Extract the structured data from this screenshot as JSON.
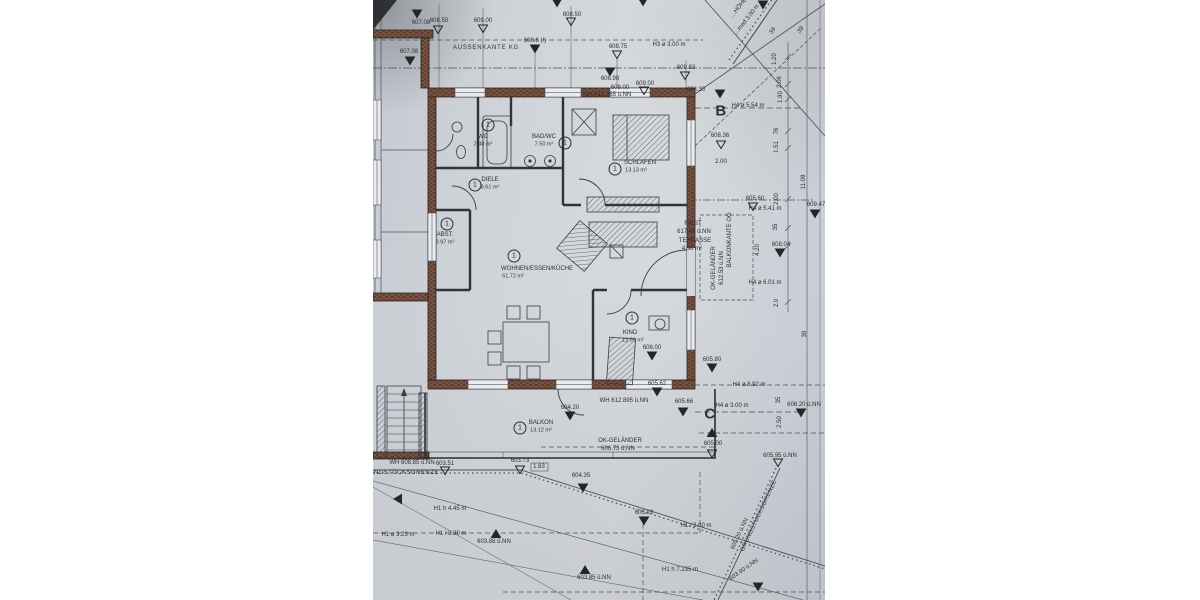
{
  "colors": {
    "paper": "#d0d4da",
    "linework": "#4c5058",
    "wall_brick": "#7a5140",
    "wall_brick_dark": "#503a2f",
    "text": "#2c2f34",
    "margin": "#ffffff"
  },
  "rooms": [
    {
      "number": "1",
      "label": "WC",
      "area": "2.40 m²",
      "x": 110,
      "y": 137,
      "badge_x": 115,
      "badge_y": 125
    },
    {
      "number": "1",
      "label": "BAD/WC",
      "area": "7.50 m²",
      "x": 171,
      "y": 137,
      "badge_x": 192,
      "badge_y": 143
    },
    {
      "number": "1",
      "label": "SCHLAFEN",
      "area": "13.13 m²",
      "x": 267,
      "y": 163,
      "ax": 263,
      "badge_x": 242,
      "badge_y": 169
    },
    {
      "number": "1",
      "label": "DIELE",
      "area": "8.61 m²",
      "x": 117,
      "y": 180,
      "badge_x": 102,
      "badge_y": 185
    },
    {
      "number": "1",
      "label": "ABST.",
      "area": "3.97 m²",
      "x": 72,
      "y": 235,
      "badge_x": 74,
      "badge_y": 224
    },
    {
      "number": "1",
      "label": "WOHNEN/ESSEN/KÜCHE",
      "area": "51.72 m²",
      "x": 164,
      "y": 269,
      "ax": 140,
      "badge_x": 141,
      "badge_y": 256
    },
    {
      "number": "1",
      "label": "KIND",
      "area": "12.99 m²",
      "x": 257,
      "y": 333,
      "ax": 260,
      "badge_x": 259,
      "badge_y": 318
    },
    {
      "number": "1",
      "label": "BALKON",
      "area": "13.12 m²",
      "x": 168,
      "y": 423,
      "badge_x": 147,
      "badge_y": 428
    }
  ],
  "section_markers": [
    {
      "letter": "B",
      "x": 348,
      "y": 111
    },
    {
      "letter": "C",
      "x": 337,
      "y": 414
    }
  ],
  "annotations": [
    {
      "t": "607.08",
      "x": 48,
      "y": 23
    },
    {
      "t": "608.50",
      "x": 66,
      "y": 21
    },
    {
      "t": "609.00",
      "x": 110,
      "y": 21
    },
    {
      "t": "608.50",
      "x": 199,
      "y": 15
    },
    {
      "t": "608.6 (!)",
      "x": 162,
      "y": 41
    },
    {
      "t": "AUSSENKANTE KG",
      "x": 113,
      "y": 48,
      "ls": 0.8
    },
    {
      "t": "608.75",
      "x": 245,
      "y": 47
    },
    {
      "t": "H3 ø 3.00 m",
      "x": 296,
      "y": 45
    },
    {
      "t": "607.08",
      "x": 36,
      "y": 52
    },
    {
      "t": "609.83",
      "x": 313,
      "y": 68
    },
    {
      "t": "606.98",
      "x": 237,
      "y": 79
    },
    {
      "t": "609.00",
      "x": 272,
      "y": 84
    },
    {
      "t": "608.00",
      "x": 247,
      "y": 88
    },
    {
      "t": "WH 612.365 ü.NN",
      "x": 234,
      "y": 95
    },
    {
      "t": "608.30",
      "x": 323,
      "y": 90
    },
    {
      "t": "H4 ø 5.54 m",
      "x": 375,
      "y": 106
    },
    {
      "t": "608.36",
      "x": 347,
      "y": 136
    },
    {
      "t": "2.00",
      "x": 348,
      "y": 162
    },
    {
      "t": "…HÖHE",
      "x": 366,
      "y": 8,
      "rot": -52
    },
    {
      "t": "…med 3.00 m",
      "x": 374,
      "y": 20,
      "rot": -52
    },
    {
      "t": "39",
      "x": 400,
      "y": 31,
      "rot": -55
    },
    {
      "t": "39",
      "x": 428,
      "y": 30,
      "rot": -55
    },
    {
      "t": "1.20",
      "x": 402,
      "y": 59,
      "rot": -90
    },
    {
      "t": "2.06",
      "x": 407,
      "y": 82,
      "rot": -90
    },
    {
      "t": "1.90",
      "x": 408,
      "y": 97,
      "rot": -90
    },
    {
      "t": "76",
      "x": 404,
      "y": 131,
      "rot": -90
    },
    {
      "t": "1.51",
      "x": 404,
      "y": 147,
      "rot": -90
    },
    {
      "t": "605.60",
      "x": 382,
      "y": 199
    },
    {
      "t": "H4 ø 5.41 m",
      "x": 392,
      "y": 209
    },
    {
      "t": "609.47",
      "x": 443,
      "y": 205
    },
    {
      "t": "11.08",
      "x": 431,
      "y": 182,
      "rot": -90
    },
    {
      "t": "2.00",
      "x": 404,
      "y": 199,
      "rot": -90
    },
    {
      "t": "35",
      "x": 403,
      "y": 227,
      "rot": -90
    },
    {
      "t": "4.20",
      "x": 385,
      "y": 250,
      "rot": -90
    },
    {
      "t": "608.04",
      "x": 408,
      "y": 245
    },
    {
      "t": "H4 ø 6.01 m",
      "x": 392,
      "y": 283
    },
    {
      "t": "2.0",
      "x": 404,
      "y": 303,
      "rot": -90
    },
    {
      "t": "39",
      "x": 432,
      "y": 334,
      "rot": -90
    },
    {
      "t": "FIRST",
      "x": 320,
      "y": 224
    },
    {
      "t": "617.84 ü.NN",
      "x": 321,
      "y": 232
    },
    {
      "t": "TERRASSE",
      "x": 322,
      "y": 241
    },
    {
      "t": "4.98 m²",
      "x": 319,
      "y": 249
    },
    {
      "t": "OK-GELÄNDER",
      "x": 341,
      "y": 268,
      "rot": -90
    },
    {
      "t": "612.53 ü.NN",
      "x": 349,
      "y": 268,
      "rot": -90
    },
    {
      "t": "BALKONKANTE OG",
      "x": 357,
      "y": 240,
      "rot": -90
    },
    {
      "t": "606.00",
      "x": 279,
      "y": 348
    },
    {
      "t": "605.80",
      "x": 339,
      "y": 360
    },
    {
      "t": "605.62",
      "x": 284,
      "y": 384
    },
    {
      "t": "H4 ø 8.92 m",
      "x": 376,
      "y": 385
    },
    {
      "t": "WH 612.895 ü.NN",
      "x": 251,
      "y": 401
    },
    {
      "t": "605.66",
      "x": 311,
      "y": 402
    },
    {
      "t": "H4 ø 3.00 m",
      "x": 359,
      "y": 406
    },
    {
      "t": "604.20",
      "x": 197,
      "y": 408
    },
    {
      "t": "OK-GELÄNDER",
      "x": 247,
      "y": 441
    },
    {
      "t": "606.73 ü.NN",
      "x": 245,
      "y": 449
    },
    {
      "t": "605.00",
      "x": 340,
      "y": 444
    },
    {
      "t": "608.20 ü.NN",
      "x": 431,
      "y": 405
    },
    {
      "t": "2.50",
      "x": 407,
      "y": 422,
      "rot": -90
    },
    {
      "t": "35",
      "x": 406,
      "y": 400,
      "rot": -90
    },
    {
      "t": "605.95 ü.NN",
      "x": 407,
      "y": 456
    },
    {
      "t": "WH 608.85 ü.NN",
      "x": 39,
      "y": 463
    },
    {
      "t": "GRUNDSTÜCKSGRENZE",
      "x": 26,
      "y": 473,
      "ls": 0.5
    },
    {
      "t": "603.51",
      "x": 72,
      "y": 464
    },
    {
      "t": "603.73",
      "x": 147,
      "y": 461
    },
    {
      "t": "1.63",
      "x": 166,
      "y": 467
    },
    {
      "t": "604.35",
      "x": 208,
      "y": 476
    },
    {
      "t": "H1 h 4.45 m",
      "x": 77,
      "y": 509
    },
    {
      "t": "H1 ø 3.23 m",
      "x": 25,
      "y": 535
    },
    {
      "t": "H1 / 3.30 m",
      "x": 78,
      "y": 534
    },
    {
      "t": "603.88 ü.NN",
      "x": 121,
      "y": 542
    },
    {
      "t": "603.93",
      "x": 271,
      "y": 513
    },
    {
      "t": "H1 / 3.00 m",
      "x": 323,
      "y": 526
    },
    {
      "t": "603.85 ü.NN",
      "x": 221,
      "y": 578
    },
    {
      "t": "H1 h 7.235 m",
      "x": 307,
      "y": 570
    },
    {
      "t": "603.90 ü.NN",
      "x": 371,
      "y": 570,
      "rot": -35
    },
    {
      "t": "GRUNDSTÜCKSGRENZE",
      "x": 386,
      "y": 516,
      "rot": -65,
      "ls": 0.4
    },
    {
      "t": "605.20 ü.NN",
      "x": 367,
      "y": 534,
      "rot": -65
    }
  ],
  "markers": [
    {
      "type": "fd",
      "x": 184,
      "y": 3
    },
    {
      "type": "fd",
      "x": 270,
      "y": 2
    },
    {
      "type": "fd",
      "x": 390,
      "y": 5
    },
    {
      "type": "fd",
      "x": 44,
      "y": 14
    },
    {
      "type": "od",
      "x": 65,
      "y": 30
    },
    {
      "type": "od",
      "x": 110,
      "y": 29
    },
    {
      "type": "od",
      "x": 198,
      "y": 22
    },
    {
      "type": "fd",
      "x": 162,
      "y": 49
    },
    {
      "type": "od",
      "x": 244,
      "y": 55
    },
    {
      "type": "fd",
      "x": 37,
      "y": 61
    },
    {
      "type": "od",
      "x": 312,
      "y": 76
    },
    {
      "type": "fd",
      "x": 237,
      "y": 72
    },
    {
      "type": "od",
      "x": 271,
      "y": 91
    },
    {
      "type": "fd",
      "x": 347,
      "y": 94
    },
    {
      "type": "od",
      "x": 348,
      "y": 145
    },
    {
      "type": "od",
      "x": 380,
      "y": 207
    },
    {
      "type": "fd",
      "x": 442,
      "y": 214
    },
    {
      "type": "fd",
      "x": 407,
      "y": 253
    },
    {
      "type": "fd",
      "x": 279,
      "y": 356
    },
    {
      "type": "fd",
      "x": 339,
      "y": 368
    },
    {
      "type": "fd",
      "x": 284,
      "y": 392
    },
    {
      "type": "fd",
      "x": 197,
      "y": 416
    },
    {
      "type": "fd",
      "x": 310,
      "y": 412
    },
    {
      "type": "fd",
      "x": 428,
      "y": 413
    },
    {
      "type": "fu",
      "x": 339,
      "y": 433
    },
    {
      "type": "od",
      "x": 339,
      "y": 454
    },
    {
      "type": "od",
      "x": 405,
      "y": 463
    },
    {
      "type": "od",
      "x": 72,
      "y": 471
    },
    {
      "type": "od",
      "x": 147,
      "y": 470
    },
    {
      "type": "fd",
      "x": 210,
      "y": 488
    },
    {
      "type": "fu",
      "x": 123,
      "y": 534
    },
    {
      "type": "fu",
      "x": 212,
      "y": 570
    },
    {
      "type": "fd",
      "x": 271,
      "y": 521
    },
    {
      "type": "fd",
      "x": 385,
      "y": 587
    },
    {
      "type": "fl",
      "x": 25,
      "y": 499
    }
  ]
}
